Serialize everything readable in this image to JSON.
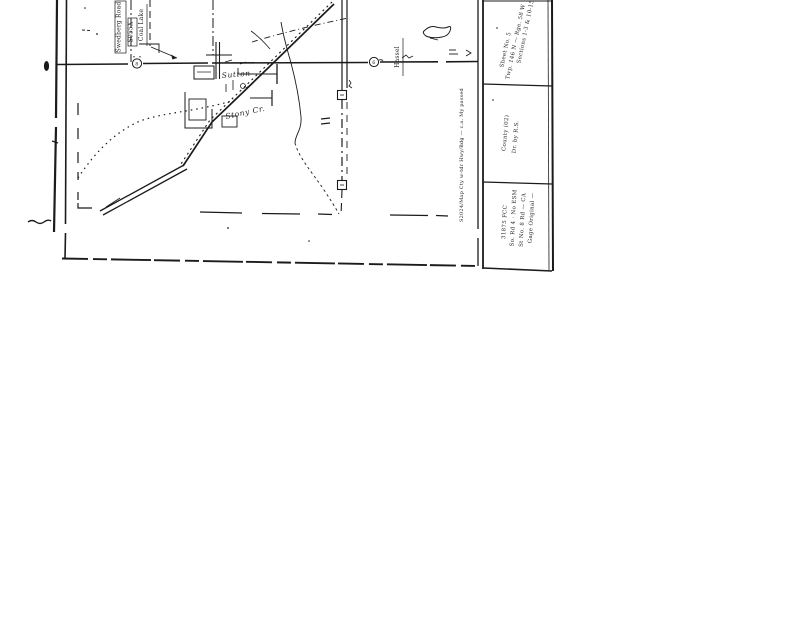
{
  "scan": {
    "ink_color": "#1b1b1b",
    "labels": {
      "swedberg_road": "Swedberg Road",
      "s055x": "S055X",
      "coal_lake": "Coal Lake",
      "town": "Sutton",
      "creek": "Stony Cr.",
      "hassel": "Hassel",
      "edge_note": "S2024/Map Cty w-tdr Hwy/Bdg — c.a. My passed",
      "route_marker_west": "8",
      "route_marker_east": "6"
    },
    "title_block": {
      "top": [
        "Sections 1-3 & 10-15",
        "Twp. 146 N — Rge. 58 W",
        "Sheet No. 5"
      ],
      "middle": [
        "Dr. by R.S.",
        "County (02)"
      ],
      "bottom": [
        "Gage Original —",
        "St No. 8 Rd — CA",
        "So. Rd 4 · No ESM",
        "31875 FCC"
      ]
    }
  }
}
